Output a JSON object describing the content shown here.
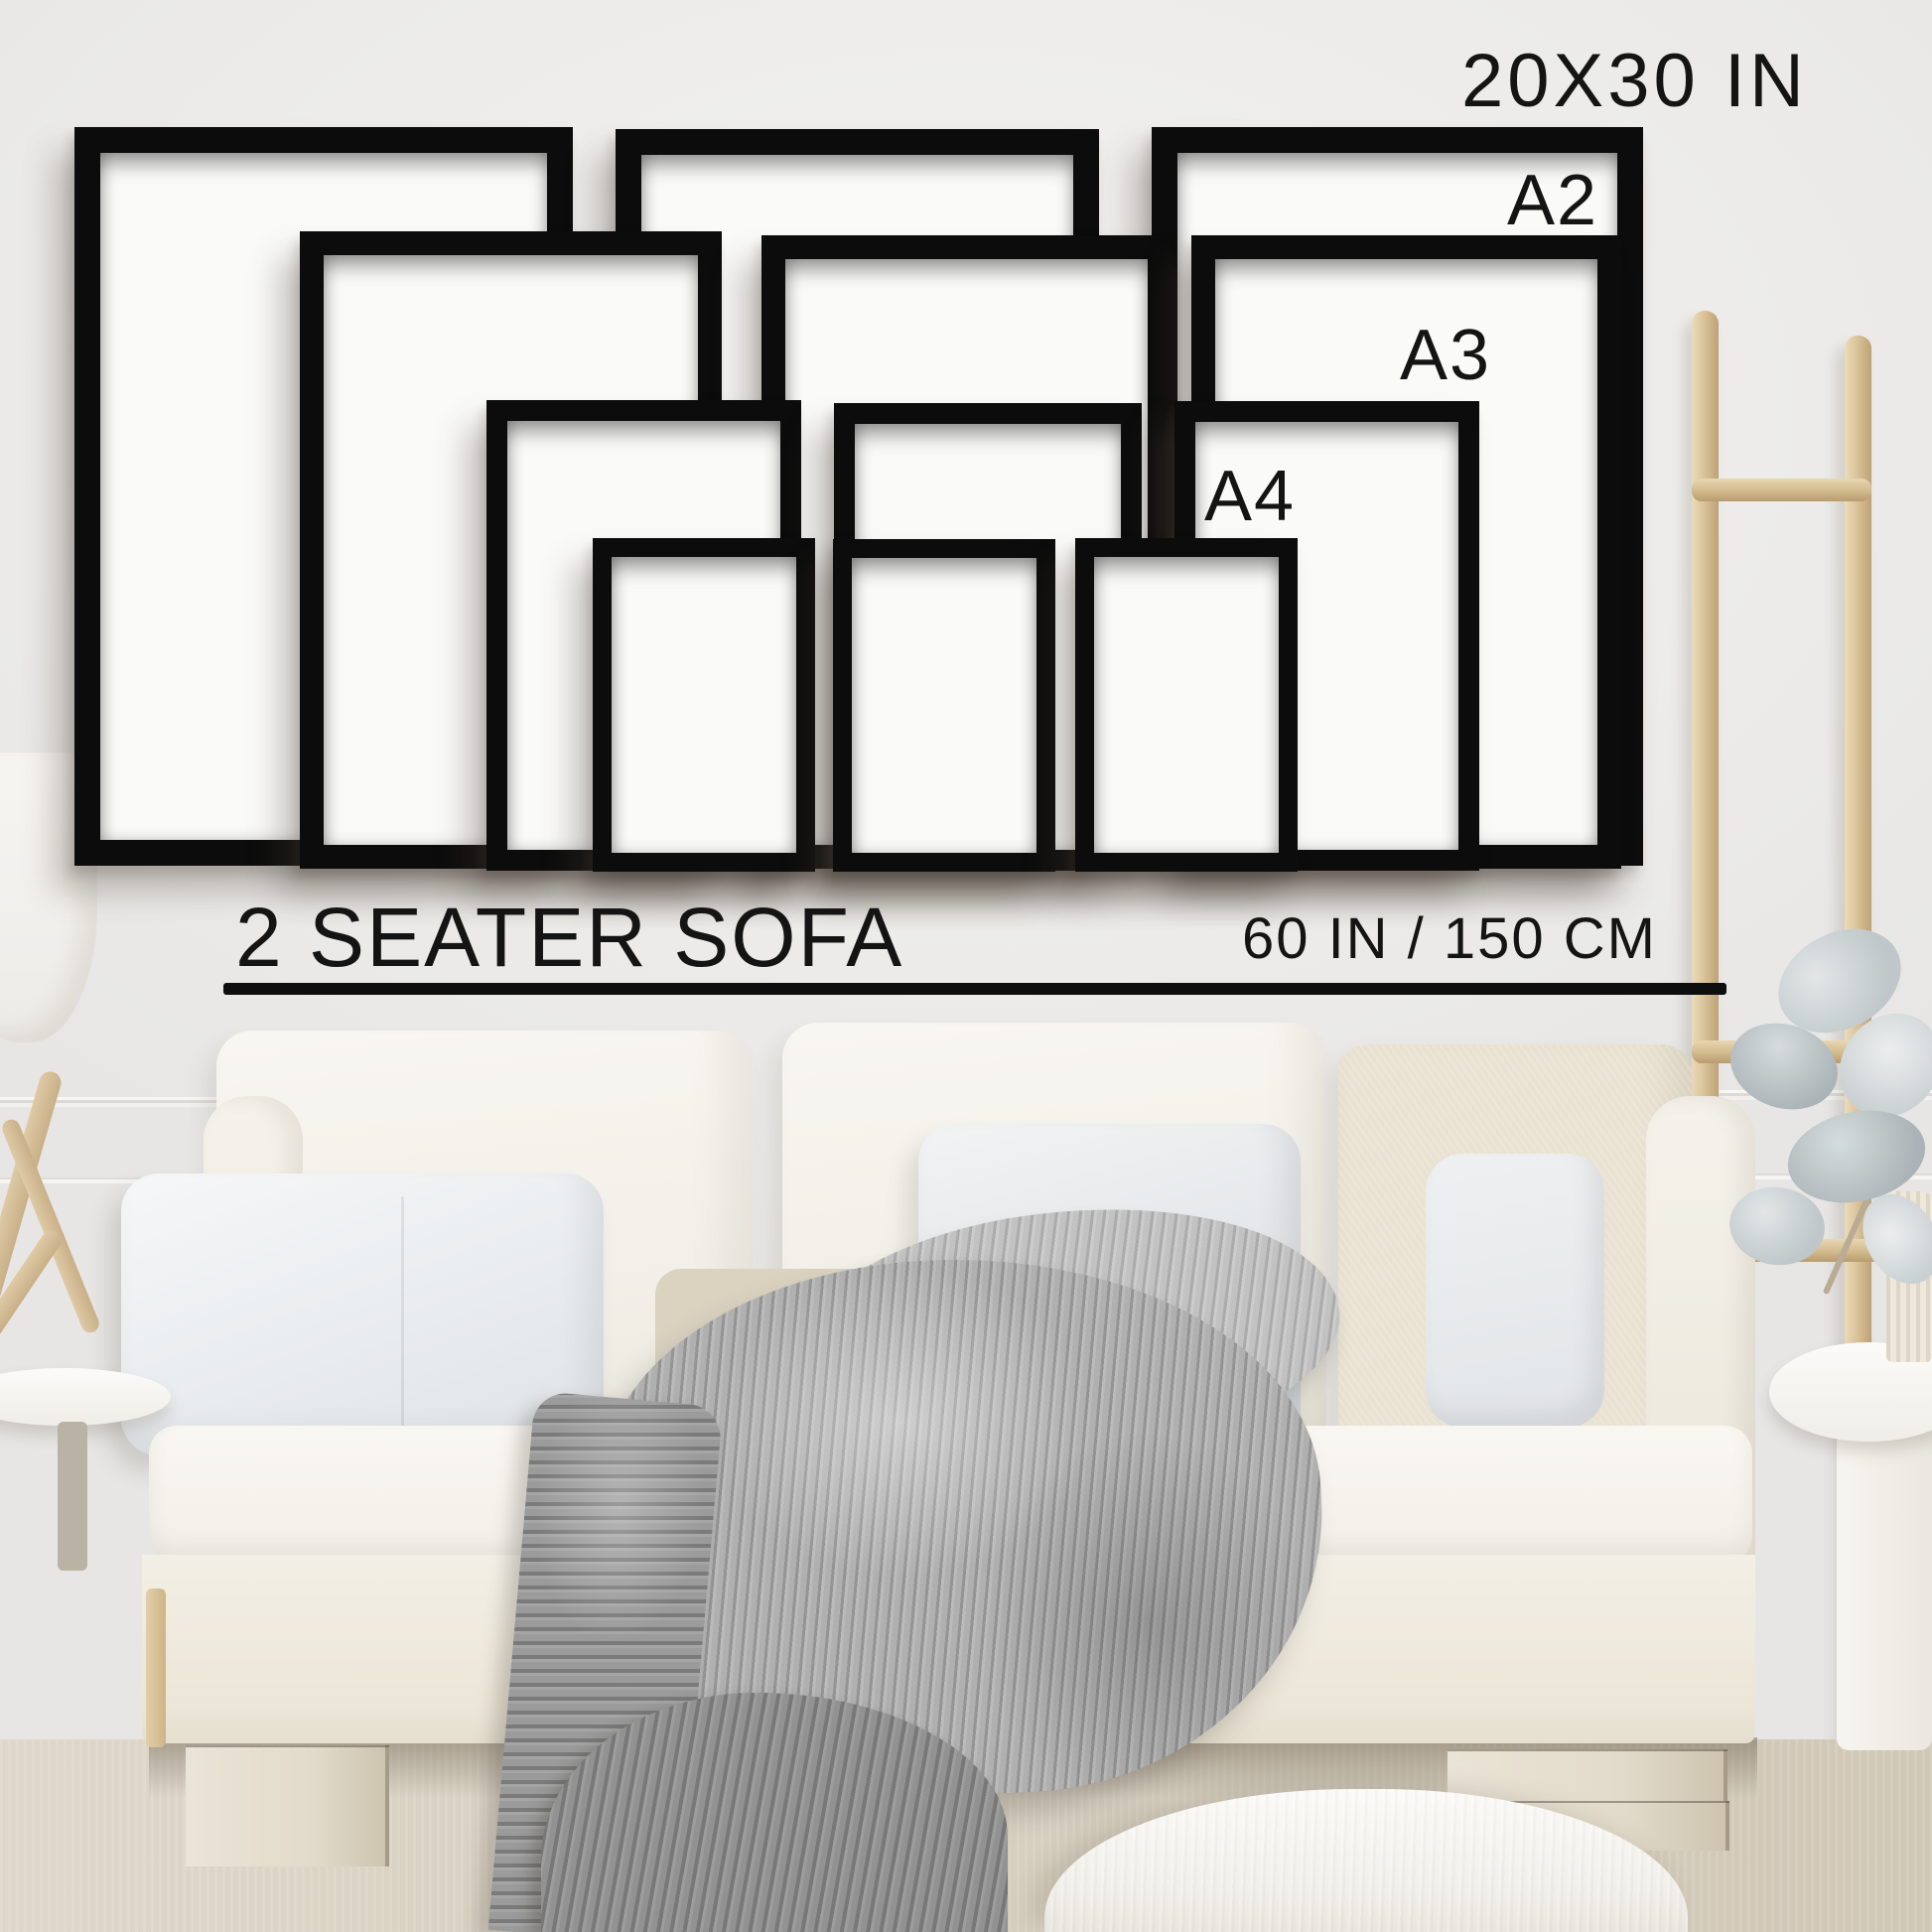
{
  "scene": {
    "description": "Frame size guide mockup above a sofa",
    "wall_text": {
      "largest_size": "20X30 IN",
      "a2": "A2",
      "a3": "A3",
      "a4": "A4"
    },
    "scale_reference": {
      "sofa_label": "2 SEATER SOFA",
      "sofa_width": "60 IN / 150 CM"
    },
    "frames": [
      {
        "size": "20X30 IN",
        "position": "back-left"
      },
      {
        "size": "20X30 IN",
        "position": "back-center"
      },
      {
        "size": "20X30 IN",
        "position": "back-right"
      },
      {
        "size": "A2",
        "position": "row2-left"
      },
      {
        "size": "A2",
        "position": "row2-center"
      },
      {
        "size": "A2",
        "position": "row2-right"
      },
      {
        "size": "A3",
        "position": "row3-left"
      },
      {
        "size": "A3",
        "position": "row3-center"
      },
      {
        "size": "A3",
        "position": "row3-right"
      },
      {
        "size": "A4",
        "position": "front-left"
      },
      {
        "size": "A4",
        "position": "front-center"
      },
      {
        "size": "A4",
        "position": "front-right"
      }
    ],
    "colors": {
      "frame": "#0c0c0c",
      "paper": "#fafaf9",
      "wall": "#edecea",
      "text": "#141414",
      "sofa": "#f3f0e9",
      "blanket": "#b0b0b0",
      "wood": "#d9c49f",
      "floor": "#d9d1c2"
    }
  }
}
